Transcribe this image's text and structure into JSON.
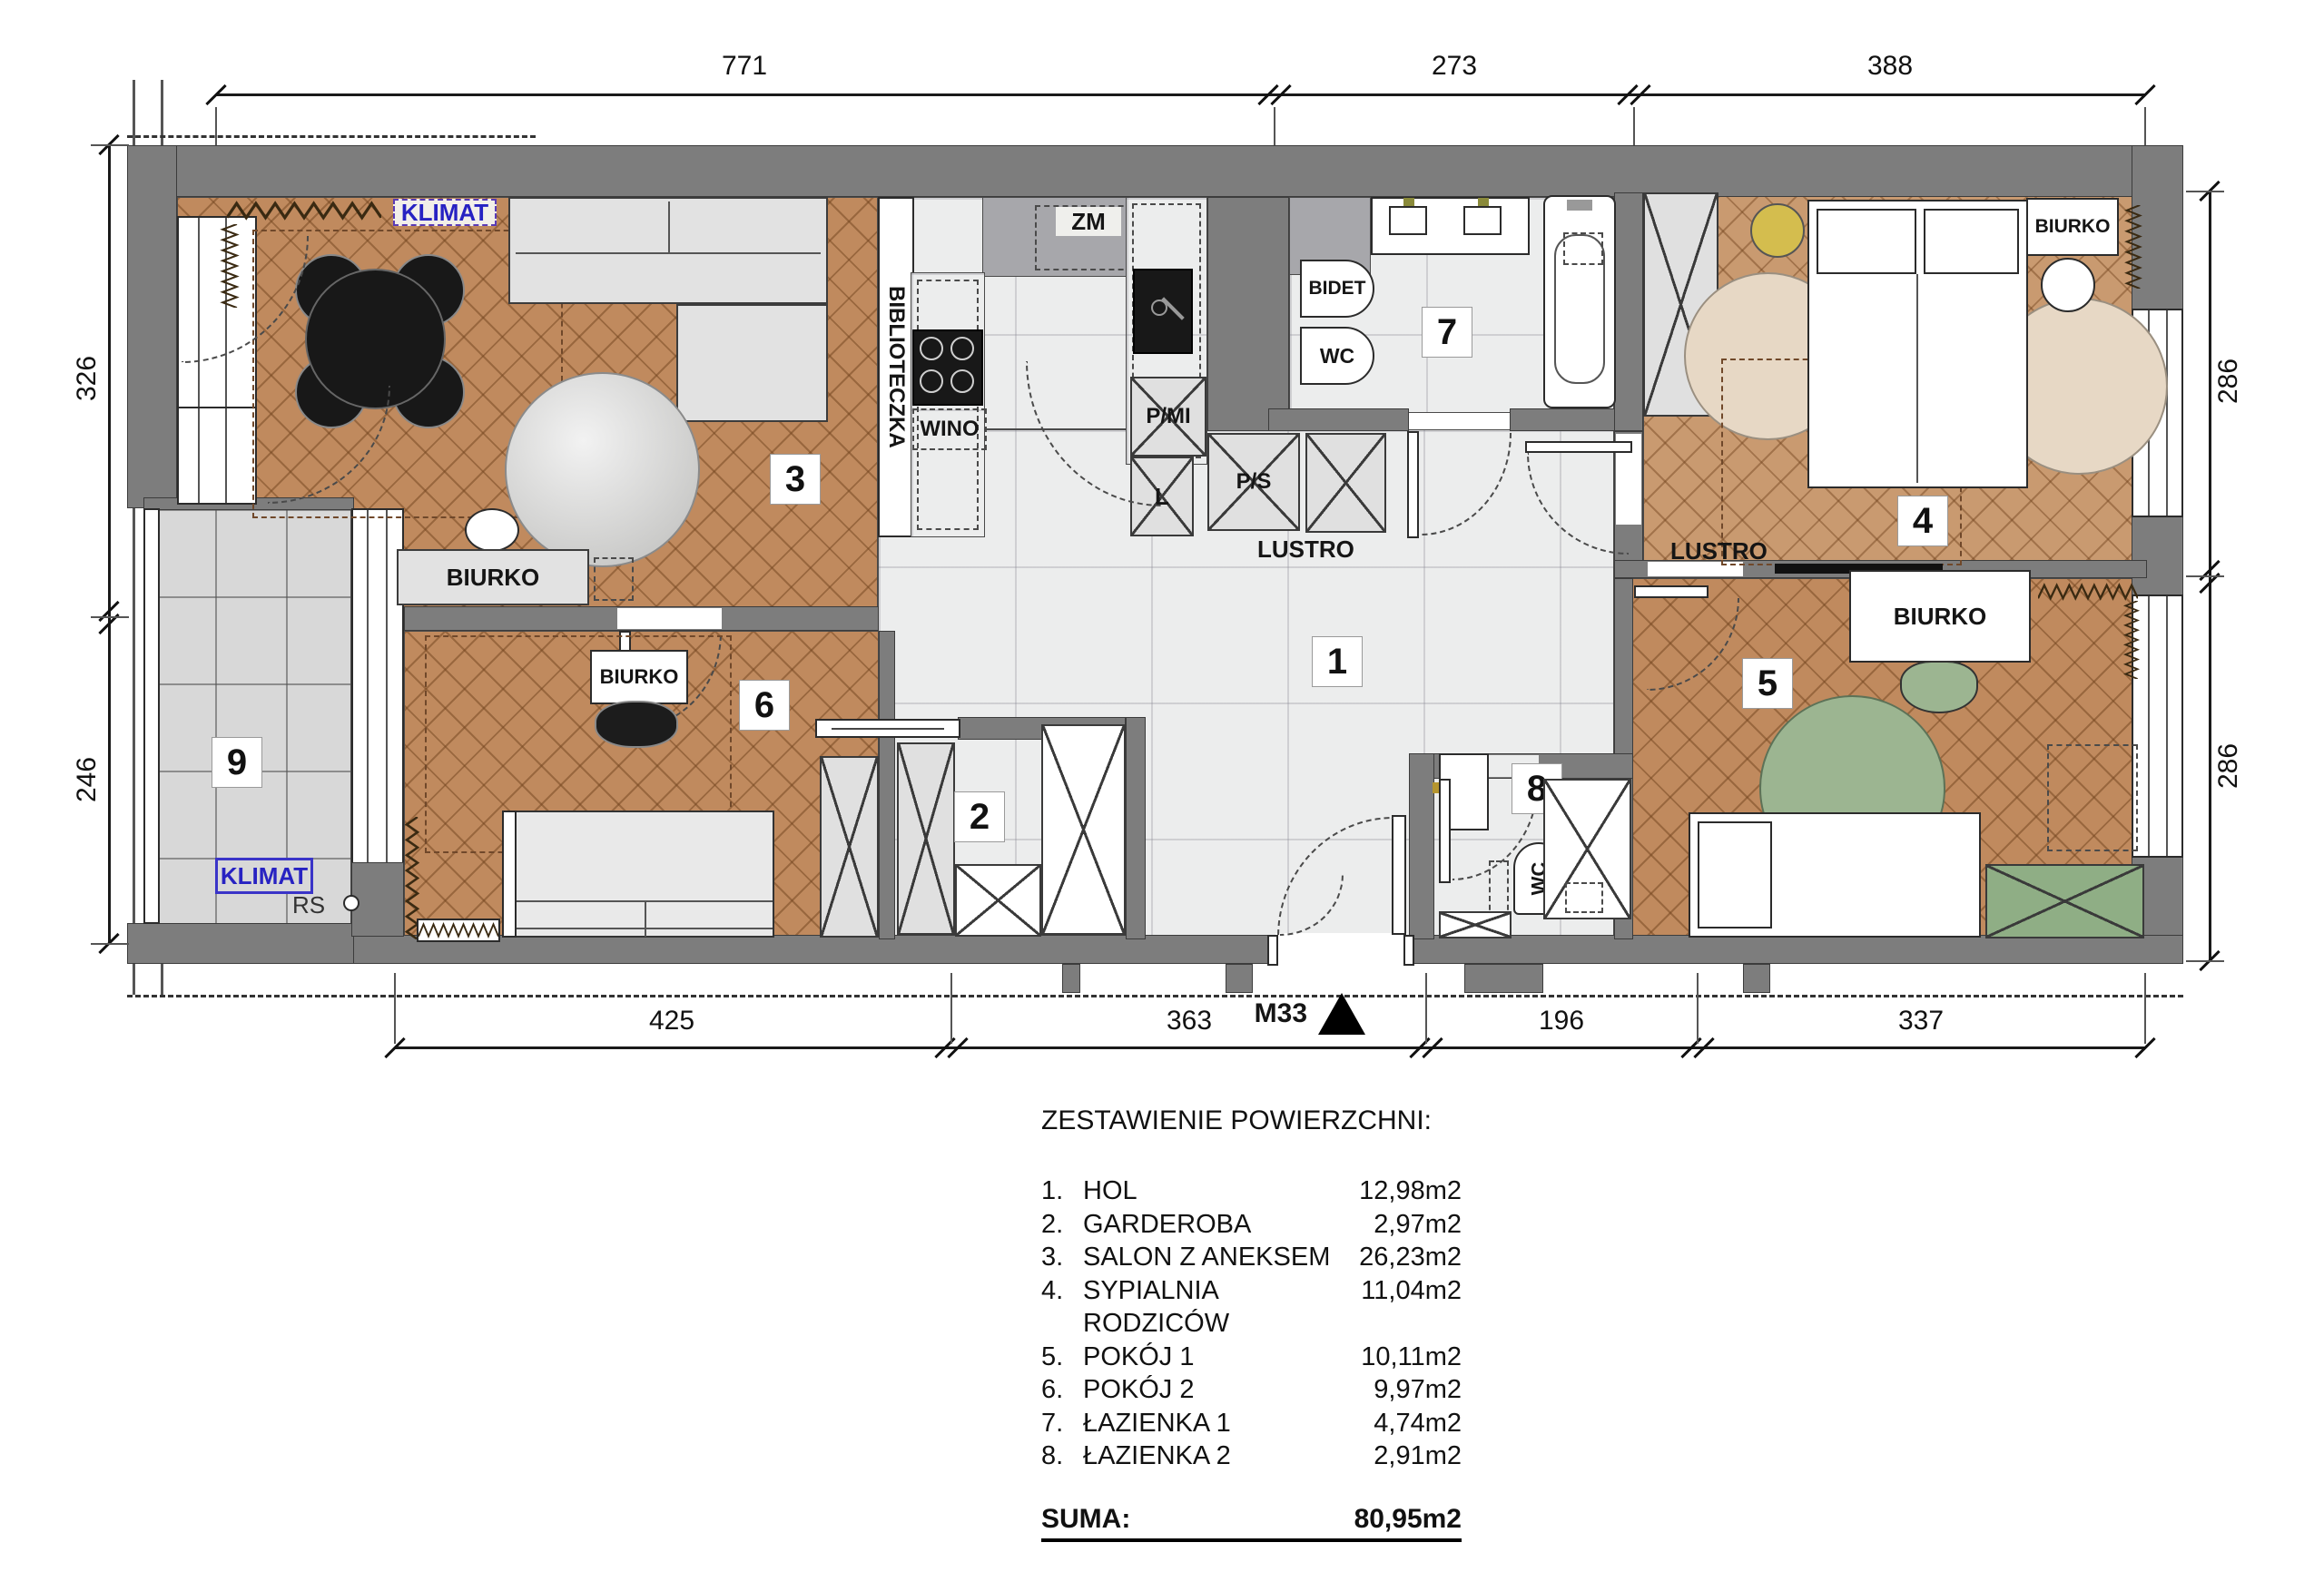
{
  "plan": {
    "marker": "M33",
    "dimensions": {
      "top": [
        "771",
        "273",
        "388"
      ],
      "bottom": [
        "425",
        "363",
        "196",
        "337"
      ],
      "left": [
        "326",
        "246"
      ],
      "right": [
        "286",
        "286"
      ]
    },
    "room_numbers": {
      "n1": "1",
      "n2": "2",
      "n3": "3",
      "n4": "4",
      "n5": "5",
      "n6": "6",
      "n7": "7",
      "n8": "8",
      "n9": "9"
    },
    "labels": {
      "klimat_salon": "KLIMAT",
      "klimat_balkon": "KLIMAT",
      "biurko_salon": "BIURKO",
      "biurko_pokoj2": "BIURKO",
      "biurko_sypialnia": "BIURKO",
      "biurko_pokoj1": "BIURKO",
      "biblioteczka": "BIBLIOTECZKA",
      "zm": "ZM",
      "wino": "WINO",
      "pmi": "P/MI",
      "l": "L",
      "ps": "P/S",
      "lustro_hol": "LUSTRO",
      "lustro_pokoj1": "LUSTRO",
      "bidet": "BIDET",
      "wc_lazienka1": "WC",
      "wc_lazienka2": "WC",
      "rs": "RS"
    },
    "legend": {
      "title": "ZESTAWIENIE POWIERZCHNI:",
      "items": [
        {
          "no": "1.",
          "name": "HOL",
          "area": "12,98m2"
        },
        {
          "no": "2.",
          "name": "GARDEROBA",
          "area": "2,97m2"
        },
        {
          "no": "3.",
          "name": "SALON Z ANEKSEM",
          "area": "26,23m2"
        },
        {
          "no": "4.",
          "name": "SYPIALNIA RODZICÓW",
          "area": "11,04m2"
        },
        {
          "no": "5.",
          "name": "POKÓJ 1",
          "area": "10,11m2"
        },
        {
          "no": "6.",
          "name": "POKÓJ 2",
          "area": "9,97m2"
        },
        {
          "no": "7.",
          "name": "ŁAZIENKA 1",
          "area": "4,74m2"
        },
        {
          "no": "8.",
          "name": "ŁAZIENKA 2",
          "area": "2,91m2"
        }
      ],
      "suma_label": "SUMA:",
      "suma_value": "80,95m2",
      "balkon": {
        "no": "9.",
        "name": "BALKON",
        "area": "3,51m2"
      }
    },
    "colors": {
      "wall": "#7d7d7d",
      "wood": "#c08a5e",
      "marble": "#eceded",
      "accent_blue": "#2722c2",
      "rug_green": "#9cb591",
      "rug_beige": "#e7d8c5",
      "circle_yellow": "#d4bd4e"
    }
  }
}
